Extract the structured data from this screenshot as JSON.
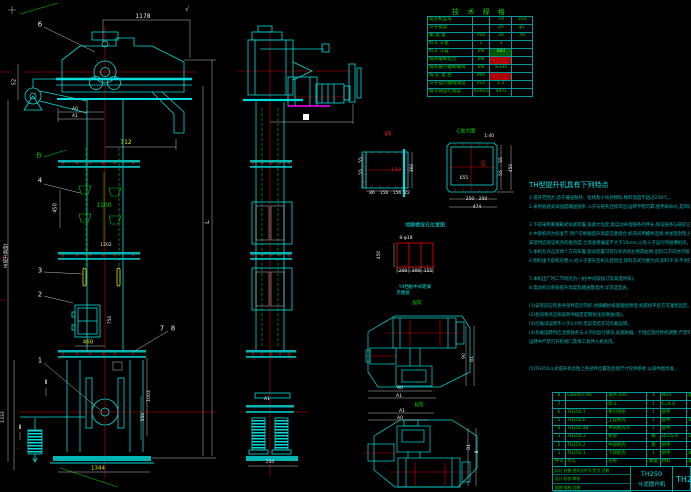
{
  "drawing": {
    "product_model": "TH250",
    "product_name": "斗式提升机",
    "drawing_no": "TH250"
  },
  "colors": {
    "background": "#000000",
    "line_cyan": "#00dcdc",
    "text_green": "#00d400",
    "centerline_red": "#d00000",
    "dim_yellow": "#e8e800",
    "dim_white": "#e8e8e8",
    "magenta": "#ff00ff"
  },
  "spec_table": {
    "title": "技 术 规 格",
    "rows": [
      {
        "cells": [
          "提升机型号",
          "",
          "TH",
          "250"
        ]
      },
      {
        "cells": [
          "斗子宽度",
          "",
          "25",
          "φ1"
        ]
      },
      {
        "cells": [
          "输 送 量",
          "mm",
          "30",
          "40"
        ]
      },
      {
        "cells": [
          "料斗 斗宽",
          "1",
          "3",
          ""
        ]
      },
      {
        "cells": [
          "料斗 斗容",
          "kN",
          "480",
          ""
        ],
        "hl": "green"
      },
      {
        "cells": [
          "链条破断拉力",
          "kN",
          "",
          ""
        ],
        "hl": "red"
      },
      {
        "cells": [
          "链条最小破断载荷",
          "kN",
          "≥335",
          ""
        ]
      },
      {
        "cells": [
          "链 轮 直 径",
          "MM",
          "",
          ""
        ],
        "hl": "red"
      },
      {
        "cells": [
          "斗子运行曲线速度",
          "m/s",
          "1.2",
          ""
        ]
      },
      {
        "cells": [
          "畚斗链运行速度",
          "m/min",
          "44.0",
          ""
        ]
      }
    ]
  },
  "notes": {
    "title": "TH型提升机具有下列特点",
    "lines": [
      "1.提升范围大,适于输送粉状、粒状及小块状物料,物料温度不超过250℃。",
      "2.采用板链式高强度输送链条,斗子与链条连接牢固,运转平稳可靠,使用寿命长,是目前国内使用较广的一种提升设备。",
      "",
      "3.下部采用重锤箱式张紧装置,张紧力恒定,能自动补偿链条的伸长,保证链条与链轮正常啮合,运转可靠。",
      "4.中部机壳为标准节,用户可根据提升高度任意组合,机壳间用螺栓连接,并加密封垫,密封性能好,防止粉尘外逸。",
      "   安装时应保证机壳的垂直度,全高垂直偏差不大于10mm,以免斗子运行时碰撞机壳。",
      "5.本机允许正反两个方向布置,驱动装置可装在机壳的左侧或右侧,出料口方向亦可按需要确定。",
      "6.物料由下部机壳喂入,经斗子提升至机头后卸出,卸料方式为重力式,卸料干净,不易回料。",
      "",
      "7.本机出厂时二节机壳为一组(中间段按订货高度供货)。",
      "8.电动机功率按提升高度及输送量选用,详见选型表。",
      "",
      "(1)安装前应检查各部件是否完好,地脚螺栓按基础图预埋,机座找平后方可灌浆固定。",
      "(2)各润滑点应按说明书规定定期加注润滑油(脂)。",
      "(3)空载试运转不少于2小时,无异常后方可负载运转。",
      "(4)负载运转时应注意链条与斗子的运行情况,发现跑偏、卡阻应及时停机调整,严禁带病运转。",
      "   运转中严禁打开检视门及将工具伸入机壳内。",
      "",
      "",
      "(5)TH250斗式提升机总图上各部件位置及连接尺寸仅供参考,以部件图为准。"
    ]
  },
  "bom": {
    "rows": [
      {
        "cells": [
          "8",
          "GB5067-85",
          "链条 200",
          "4",
          "M24",
          "配套"
        ]
      },
      {
        "cells": [
          "7",
          "",
          "料斗",
          "1",
          "L=9.0",
          ""
        ]
      },
      {
        "cells": [
          "6",
          "TH250.7",
          "牵引链条",
          "1",
          "部件",
          ""
        ]
      },
      {
        "cells": [
          "5",
          "TH250.6",
          "上段机壳",
          "1",
          "部件",
          "635"
        ]
      },
      {
        "cells": [
          "4",
          "TH250.4B",
          "中间机壳节",
          "1",
          "部件",
          ""
        ]
      },
      {
        "cells": [
          "3",
          "TH250.3",
          "机架",
          "根",
          "Q235-A",
          "200"
        ]
      },
      {
        "cells": [
          "2",
          "TH250.2",
          "中部机壳",
          "套",
          "部件",
          ""
        ]
      },
      {
        "cells": [
          "1",
          "TH250.1",
          "下部机壳",
          "1",
          "部件",
          "850"
        ]
      },
      {
        "cells": [
          "件号",
          "代号",
          "名称",
          "数量",
          "材料",
          "备注"
        ]
      }
    ]
  },
  "title_block": {
    "model": "TH250",
    "product_name": "斗式提升机",
    "drawing_no": "TH250",
    "revision_labels": "标记 处数 更改文件号 签字 日期",
    "sig_labels": "设计  校核  审核",
    "extra_labels": "描图  描校  日期"
  },
  "annotations": [
    {
      "t": "√",
      "x": 187,
      "y": 10,
      "c": "white",
      "s": 6,
      "n": "surface-finish-mark"
    },
    {
      "t": "1178",
      "x": 143,
      "y": 17,
      "c": "white",
      "s": 6
    },
    {
      "t": "6",
      "x": 40,
      "y": 25,
      "c": "white",
      "s": 7,
      "n": "balloon-6"
    },
    {
      "t": "52",
      "x": 15,
      "y": 82,
      "c": "white",
      "r": 1,
      "s": 5
    },
    {
      "t": "A0",
      "x": 75,
      "y": 110,
      "c": "white",
      "s": 4.5
    },
    {
      "t": "A1",
      "x": 75,
      "y": 117,
      "c": "white",
      "s": 4.5
    },
    {
      "t": "712",
      "x": 126,
      "y": 143,
      "c": "yellow",
      "s": 6
    },
    {
      "t": "B",
      "x": 39,
      "y": 156,
      "c": "green",
      "s": 7,
      "n": "view-letter-b"
    },
    {
      "t": "4",
      "x": 40,
      "y": 181,
      "c": "white",
      "s": 7,
      "n": "balloon-4"
    },
    {
      "t": "450",
      "x": 56,
      "y": 208,
      "c": "white",
      "r": 1,
      "s": 5
    },
    {
      "t": "1100",
      "x": 104,
      "y": 206,
      "c": "green",
      "s": 6
    },
    {
      "t": "1202",
      "x": 106,
      "y": 246,
      "c": "white",
      "s": 4.5
    },
    {
      "t": "3",
      "x": 40,
      "y": 271,
      "c": "white",
      "s": 7,
      "n": "balloon-3"
    },
    {
      "t": "2",
      "x": 40,
      "y": 295,
      "c": "white",
      "s": 7,
      "n": "balloon-2"
    },
    {
      "t": "750",
      "x": 111,
      "y": 320,
      "c": "white",
      "r": 1,
      "s": 4.5
    },
    {
      "t": "7",
      "x": 162,
      "y": 329,
      "c": "white",
      "s": 7,
      "n": "balloon-7"
    },
    {
      "t": "8",
      "x": 173,
      "y": 329,
      "c": "white",
      "s": 7,
      "n": "balloon-8"
    },
    {
      "t": "460",
      "x": 88,
      "y": 343,
      "c": "yellow",
      "s": 5.5
    },
    {
      "t": "1",
      "x": 40,
      "y": 361,
      "c": "white",
      "s": 7,
      "n": "balloon-1"
    },
    {
      "t": "Ⅱ",
      "x": 46,
      "y": 383,
      "c": "white",
      "s": 6,
      "n": "section-mark"
    },
    {
      "t": "Ⅱ",
      "x": 20,
      "y": 428,
      "c": "white",
      "s": 6,
      "n": "section-mark"
    },
    {
      "t": "1333",
      "x": 4,
      "y": 417,
      "c": "white",
      "r": 1,
      "s": 4.5
    },
    {
      "t": "H(提升高度)",
      "x": 7,
      "y": 256,
      "c": "white",
      "r": 1,
      "s": 4.5
    },
    {
      "t": "1003",
      "x": 150,
      "y": 396,
      "c": "white",
      "r": 1,
      "s": 4.5
    },
    {
      "t": "550",
      "x": 144,
      "y": 417,
      "c": "white",
      "r": 1,
      "s": 4.5
    },
    {
      "t": "1344",
      "x": 98,
      "y": 469,
      "c": "yellow",
      "s": 5.5
    },
    {
      "t": "L",
      "x": 207,
      "y": 222,
      "c": "white",
      "r": 1,
      "s": 6.5
    },
    {
      "t": "A1",
      "x": 267,
      "y": 400,
      "c": "white",
      "s": 4.5
    },
    {
      "t": "550",
      "x": 270,
      "y": 463,
      "c": "white",
      "s": 4.5
    },
    {
      "t": "Ⅰ向",
      "x": 388,
      "y": 135,
      "c": "red",
      "s": 5.5,
      "n": "view-label-i"
    },
    {
      "t": "1:10",
      "x": 396,
      "y": 171,
      "c": "red",
      "s": 4.5
    },
    {
      "t": "55",
      "x": 362,
      "y": 160,
      "c": "white",
      "r": 1,
      "s": 4.5
    },
    {
      "t": "55",
      "x": 362,
      "y": 172,
      "c": "white",
      "r": 1,
      "s": 4.5
    },
    {
      "t": "360",
      "x": 413,
      "y": 168,
      "c": "white",
      "r": 1,
      "s": 4.5
    },
    {
      "t": "86",
      "x": 372,
      "y": 194,
      "c": "white",
      "s": 4.5
    },
    {
      "t": "156",
      "x": 384,
      "y": 194,
      "c": "white",
      "s": 4.5
    },
    {
      "t": "156",
      "x": 397,
      "y": 194,
      "c": "white",
      "s": 4.5
    },
    {
      "t": "22",
      "x": 407,
      "y": 194,
      "c": "white",
      "s": 4.5
    },
    {
      "t": "C放大图",
      "x": 466,
      "y": 132,
      "c": "green",
      "s": 5,
      "n": "view-label-c"
    },
    {
      "t": "1:40",
      "x": 489,
      "y": 137,
      "c": "white",
      "s": 4.5
    },
    {
      "t": "655",
      "x": 464,
      "y": 179,
      "c": "white",
      "s": 4.5
    },
    {
      "t": "65",
      "x": 485,
      "y": 163,
      "c": "red",
      "r": 1,
      "s": 4.5
    },
    {
      "t": "55",
      "x": 502,
      "y": 160,
      "c": "white",
      "r": 1,
      "s": 4.5
    },
    {
      "t": "55",
      "x": 502,
      "y": 173,
      "c": "white",
      "r": 1,
      "s": 4.5
    },
    {
      "t": "450",
      "x": 512,
      "y": 168,
      "c": "white",
      "r": 1,
      "s": 4.5
    },
    {
      "t": "250",
      "x": 470,
      "y": 200,
      "c": "white",
      "s": 4.5
    },
    {
      "t": "250",
      "x": 483,
      "y": 200,
      "c": "white",
      "s": 4.5
    },
    {
      "t": "474",
      "x": 477,
      "y": 208,
      "c": "white",
      "s": 4.5
    },
    {
      "t": "地脚螺栓孔位置图",
      "x": 425,
      "y": 226,
      "c": "cyan",
      "s": 5,
      "n": "detail-caption"
    },
    {
      "t": "8-φ18",
      "x": 406,
      "y": 239,
      "c": "white",
      "s": 4.5
    },
    {
      "t": "450",
      "x": 380,
      "y": 255,
      "c": "white",
      "r": 1,
      "s": 4.5
    },
    {
      "t": "200",
      "x": 403,
      "y": 272,
      "c": "white",
      "s": 4.5
    },
    {
      "t": "300",
      "x": 416,
      "y": 272,
      "c": "white",
      "s": 4.5
    },
    {
      "t": "155",
      "x": 428,
      "y": 272,
      "c": "white",
      "s": 4.5
    },
    {
      "t": "Y4挡板中间距离",
      "x": 415,
      "y": 288,
      "c": "cyan",
      "s": 4.5
    },
    {
      "t": "见图纸",
      "x": 403,
      "y": 294,
      "c": "cyan",
      "s": 4.5
    },
    {
      "t": "B向",
      "x": 417,
      "y": 304,
      "c": "green",
      "s": 5.5,
      "n": "view-label-b-upper"
    },
    {
      "t": "90",
      "x": 465,
      "y": 356,
      "c": "white",
      "r": 1,
      "s": 4.5
    },
    {
      "t": "B1",
      "x": 473,
      "y": 359,
      "c": "white",
      "r": 1,
      "s": 4.5
    },
    {
      "t": "A0",
      "x": 400,
      "y": 389,
      "c": "white",
      "s": 4.5
    },
    {
      "t": "A1",
      "x": 399,
      "y": 397,
      "c": "white",
      "s": 4.5
    },
    {
      "t": "B向",
      "x": 419,
      "y": 406,
      "c": "green",
      "s": 5.5,
      "n": "view-label-b-lower"
    },
    {
      "t": "A1",
      "x": 402,
      "y": 412,
      "c": "white",
      "s": 4.5
    },
    {
      "t": "A0",
      "x": 400,
      "y": 419,
      "c": "white",
      "s": 4.5
    },
    {
      "t": "B1",
      "x": 470,
      "y": 447,
      "c": "white",
      "r": 1,
      "s": 4.5
    },
    {
      "t": "B",
      "x": 478,
      "y": 452,
      "c": "white",
      "r": 1,
      "s": 4.5
    }
  ]
}
